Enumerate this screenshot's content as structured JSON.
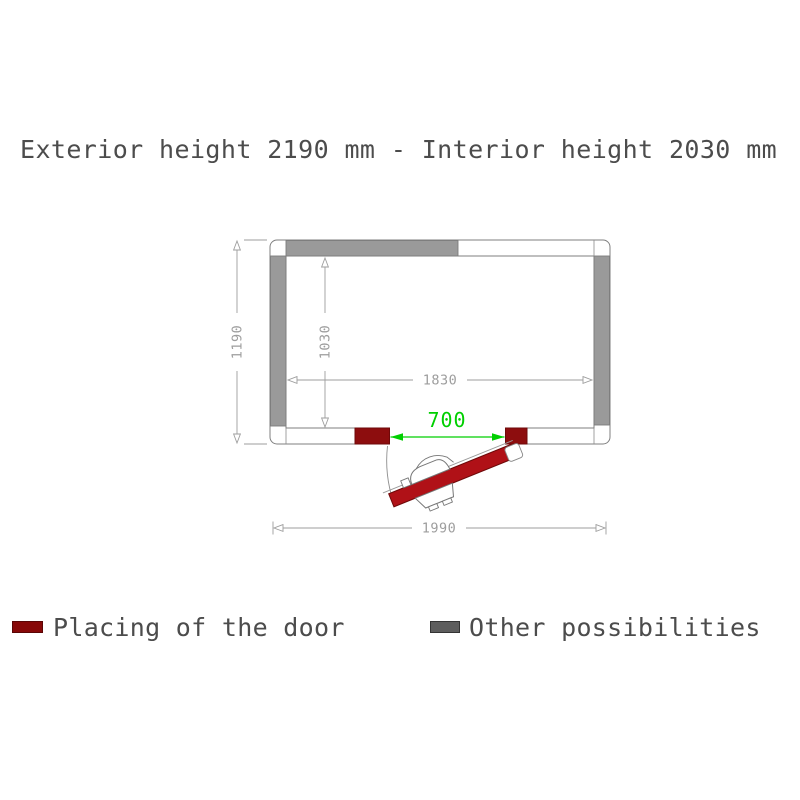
{
  "title": "Exterior height 2190 mm - Interior height 2030 mm",
  "diagram": {
    "dimensions": {
      "exterior_width": "1990",
      "exterior_depth": "1190",
      "interior_width": "1830",
      "interior_depth": "1030",
      "door_opening": "700"
    },
    "colors": {
      "wall_gray": "#9a9a9a",
      "outline": "#7f7f7f",
      "dim_gray": "#9d9d9d",
      "door_leaf": "#b01117",
      "door_block": "#8d0d0e",
      "green": "#00cf00"
    }
  },
  "legend": {
    "items": [
      {
        "label": "Placing of the door",
        "swatch": "#870808",
        "swatch_border": "#5a0505"
      },
      {
        "label": "Other possibilities",
        "swatch": "#5d5d5d",
        "swatch_border": "#343434"
      }
    ]
  }
}
